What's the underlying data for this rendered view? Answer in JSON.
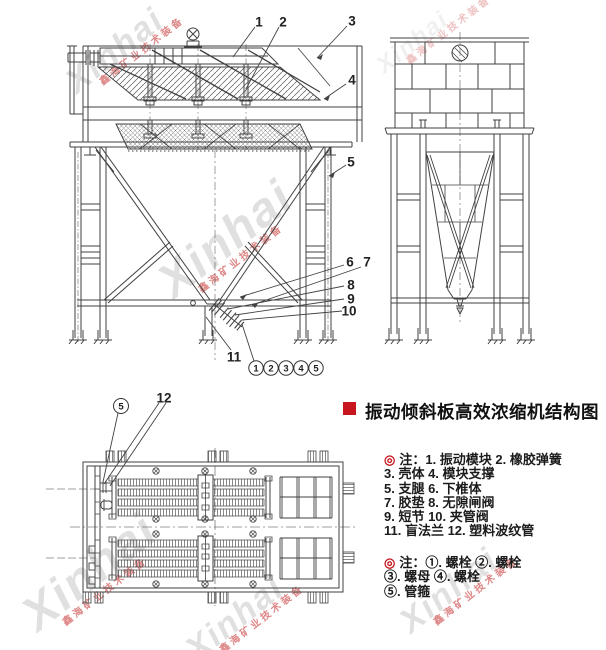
{
  "title": {
    "text": "振动倾斜板高效浓缩机结构图"
  },
  "watermark": {
    "brand": "Xinhai",
    "company": "鑫海矿业技术装备"
  },
  "callouts": {
    "front": [
      "1",
      "2",
      "3",
      "4",
      "5",
      "6",
      "7",
      "8",
      "9",
      "10",
      "11"
    ],
    "assembly_row": [
      "1",
      "2",
      "3",
      "4",
      "5"
    ],
    "plan": {
      "clamp_num": "5",
      "pipe": "12"
    }
  },
  "notes": {
    "marker": "◎",
    "parts": {
      "head": "注：1. 振动模块 2. 橡胶弹簧",
      "lines": [
        "3. 壳体 4. 模块支撑",
        "5. 支腿 6. 下椎体",
        "7. 胶垫 8. 无隙闸阀",
        "9. 短节 10. 夹管阀",
        "11. 盲法兰 12. 塑料波纹管"
      ]
    },
    "fasteners": {
      "head": "注：①. 螺栓 ②. 螺栓",
      "lines": [
        "③. 螺母 ④. 螺栓",
        "⑤. 管箍"
      ]
    }
  },
  "colors": {
    "line": "#414141",
    "accent_red": "#c8161e",
    "watermark_gray": "#c7c7c7",
    "watermark_red": "#d05454"
  }
}
